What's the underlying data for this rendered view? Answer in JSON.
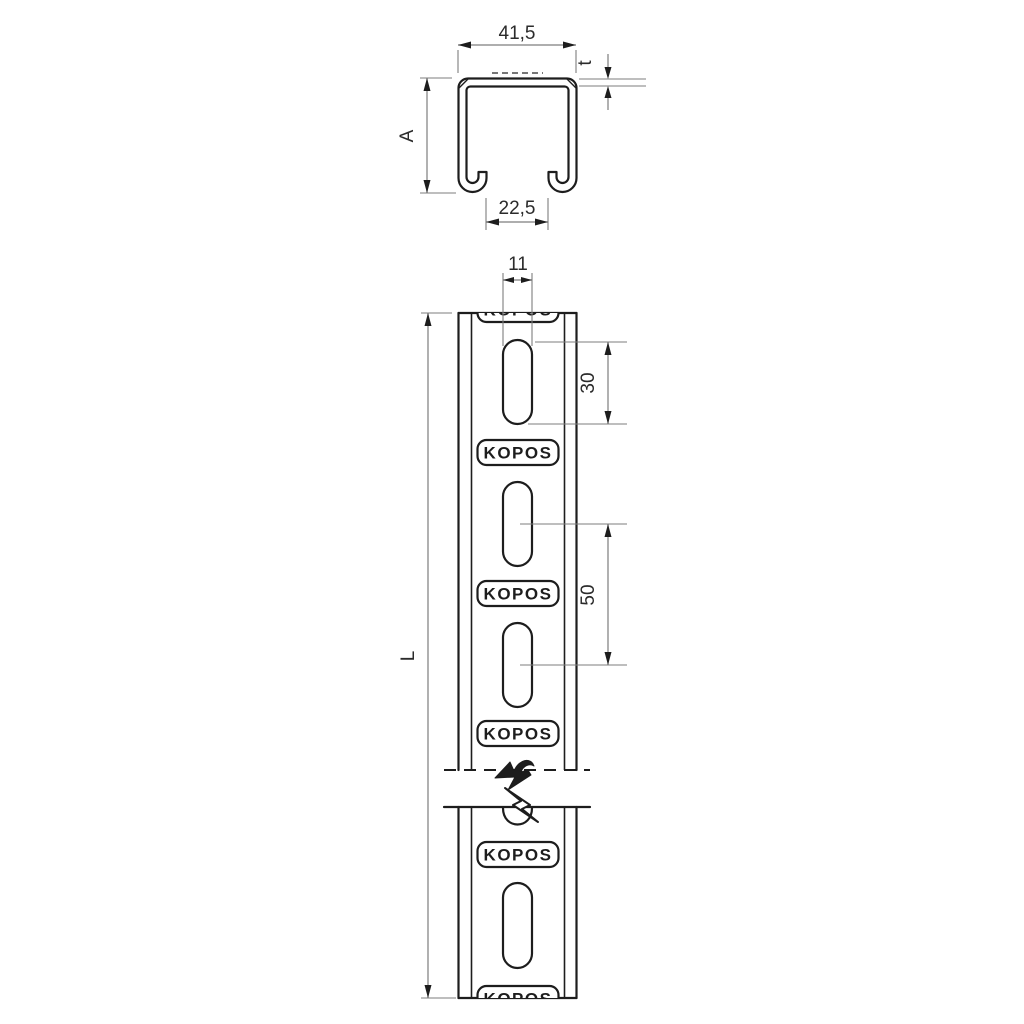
{
  "brand": "KOPOS",
  "views": {
    "cross_section": {
      "dims": {
        "top_width": "41,5",
        "wall_thickness": "t",
        "profile_height": "A",
        "bottom_opening": "22,5"
      }
    },
    "front": {
      "dims": {
        "slot_width": "11",
        "slot_length": "30",
        "slot_pitch": "50",
        "profile_length": "L"
      }
    }
  },
  "colors": {
    "outline": "#1d1d1d",
    "dimension_lines": "#7d7d7d",
    "text": "#2b2b2b",
    "background": "#ffffff"
  }
}
